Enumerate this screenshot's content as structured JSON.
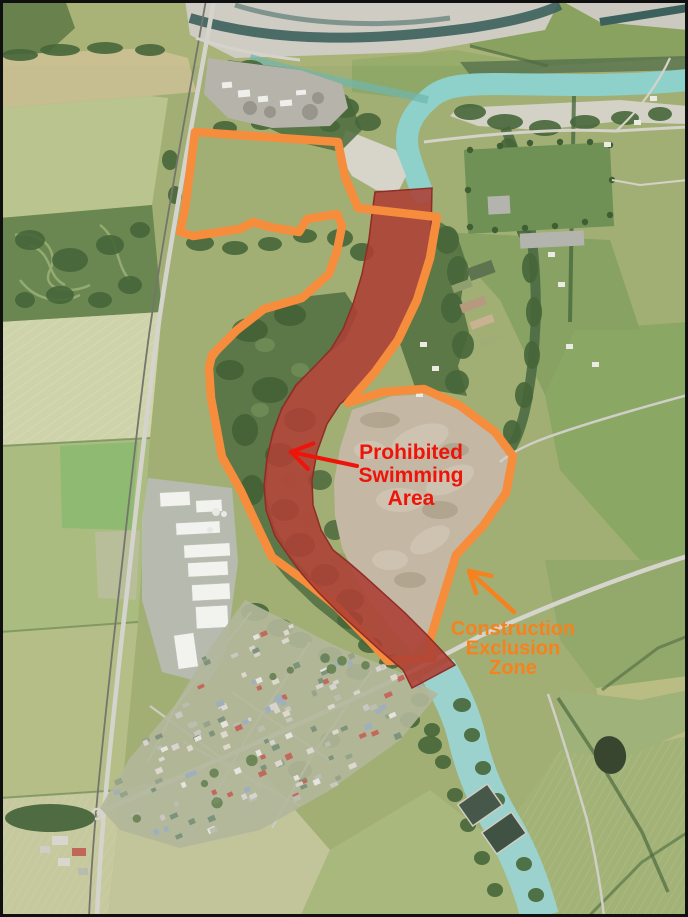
{
  "map": {
    "description": "Aerial photo map with annotated zones",
    "frame_color": "#101010",
    "annotations": {
      "prohibited": {
        "label": [
          "Prohibited",
          "Swimming",
          "Area"
        ],
        "text_color": "#ee1409",
        "font_size": 21,
        "line_height": 23,
        "label_x": 411,
        "label_first_baseline_y": 459,
        "fill_color": "#ad3f36",
        "fill_opacity": 0.88,
        "edge_color": "#8f2d25",
        "points": "375,192 432,188 431,235 424,275 412,312 396,342 374,372 352,394 340,404 327,424 317,452 312,480 313,505 321,530 333,550 348,562 362,574 382,592 404,612 426,634 443,652 455,665 412,688 403,670 382,652 360,632 338,612 318,592 302,574 290,558 275,536 266,510 264,485 267,458 273,432 282,408 296,385 316,365 331,349 343,329 353,304 362,274 369,239 372,214",
        "arrow": {
          "tail": [
            357,
            466
          ],
          "tip": [
            291,
            452
          ],
          "width": 4,
          "barb_len": 24,
          "barb_deg": 33
        }
      },
      "exclusion": {
        "label": [
          "Construction",
          "Exclusion",
          "Zone"
        ],
        "text_color": "#f5821e",
        "font_size": 20,
        "line_height": 19.5,
        "label_x": 513,
        "label_first_baseline_y": 635,
        "line_color": "#f68d3d",
        "line_width": 8.5,
        "points": "195,132 338,142 345,177 358,208 437,217 430,258 417,300 398,340 375,372 348,403 383,392 424,389 459,405 495,432 513,456 506,493 483,526 456,555 444,594 430,640 433,658 388,661 370,641 337,607 305,581 272,557 261,534 241,491 222,457 211,398 209,368 212,355 237,330 264,309 302,298 329,274 337,251 342,226 337,214 307,219 299,232 270,227 253,222 240,229 193,236 180,232 185,209",
        "points_over": "345,177 358,208 437,217 430,258 417,300 398,340 375,372 348,403",
        "arrow": {
          "tail": [
            514,
            612
          ],
          "tip": [
            469,
            571
          ],
          "width": 4.5,
          "barb_len": 23,
          "barb_deg": 30
        }
      }
    }
  }
}
